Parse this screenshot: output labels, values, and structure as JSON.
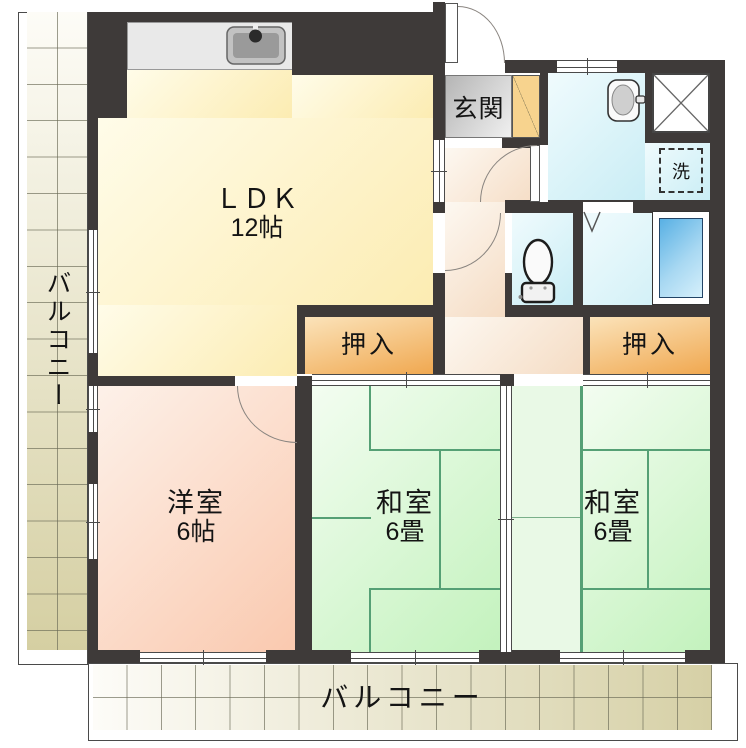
{
  "floorplan": {
    "ldk": {
      "label": "ＬＤＫ",
      "area": "12帖"
    },
    "genkan": {
      "label": "玄関"
    },
    "western_room": {
      "label": "洋室",
      "area": "6帖"
    },
    "japanese_room_center": {
      "label": "和室",
      "area": "6畳"
    },
    "japanese_room_right": {
      "label": "和室",
      "area": "6畳"
    },
    "closet_left": {
      "label": "押入"
    },
    "closet_right": {
      "label": "押入"
    },
    "laundry_mark": {
      "label": "洗"
    },
    "balcony_left": {
      "label": "バルコニー"
    },
    "balcony_bottom": {
      "label": "バルコニー"
    },
    "icons": {
      "kitchen_sink": "kitchen-sink-icon",
      "washbasin": "washbasin-icon",
      "toilet": "toilet-icon",
      "bathtub": "bathtub-icon",
      "pipe_shaft": "pipe-shaft-x-icon",
      "folding_door": "folding-door-mark"
    },
    "colors": {
      "wall": "#3e3a39",
      "ldk": "#fcecb2",
      "western_room": "#fac9af",
      "tatami": "#c3f2bd",
      "closet": "#f0a850",
      "water_area": "#c9edf5",
      "hallway": "#f5dcc4",
      "bathtub": "#58b0e4",
      "balcony": "#d5cfa2",
      "genkan_floor": "#c0c0c0",
      "shoe_cabinet": "#f7d38e"
    }
  }
}
